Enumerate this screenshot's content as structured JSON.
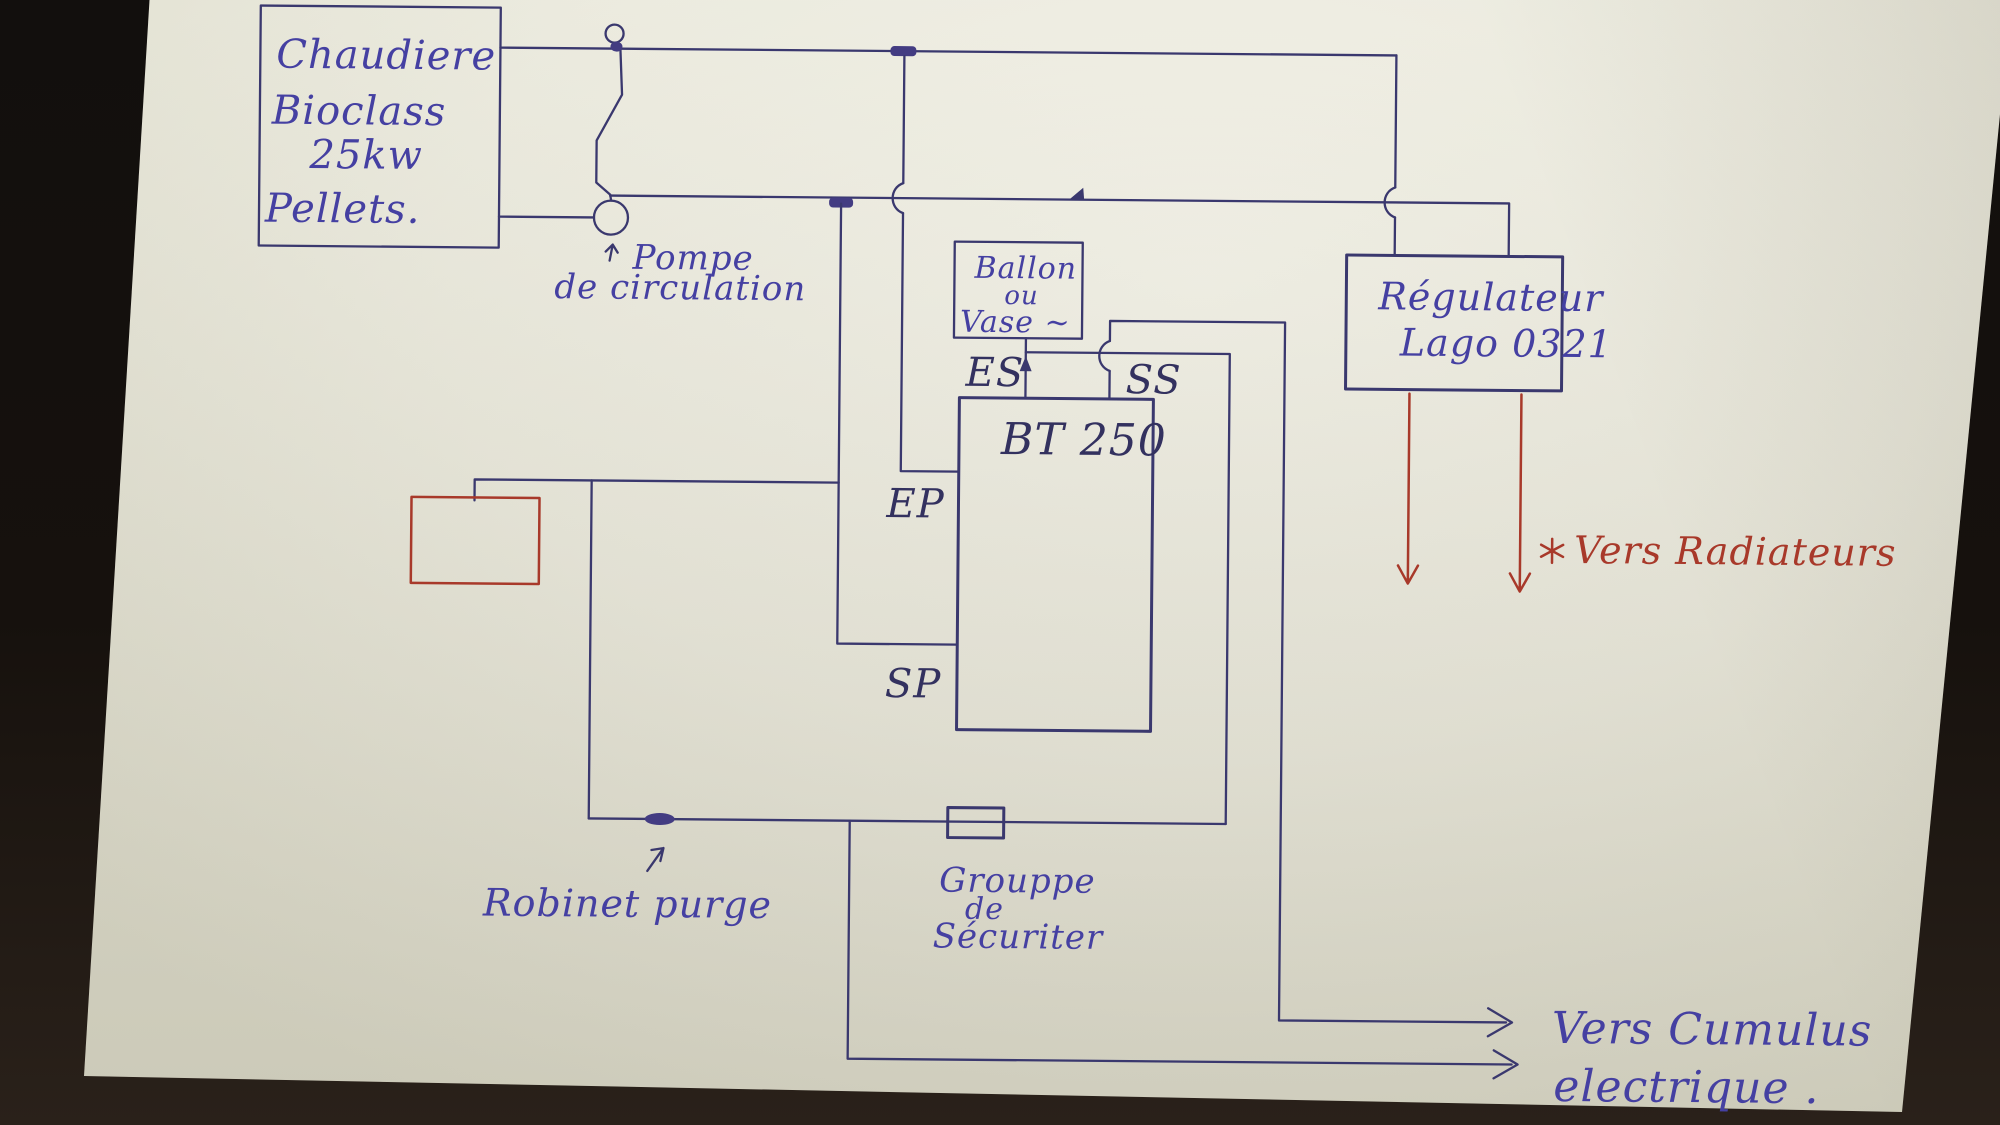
{
  "boiler": {
    "lines": [
      "Chaudiere",
      "Bioclass",
      "25kw",
      "Pellets."
    ]
  },
  "pump": {
    "line1": "Pompe",
    "line2": "de circulation"
  },
  "expansion_tank": {
    "line1": "Ballon",
    "line2": "ou",
    "line3": "Vase ~"
  },
  "buffer_tank": {
    "label": "BT 250",
    "port_es": "ES",
    "port_ss": "SS",
    "port_ep": "EP",
    "port_sp": "SP"
  },
  "regulator": {
    "line1": "Régulateur",
    "line2": "Lago 0321"
  },
  "radiators_note": {
    "label": "Vers Radiateurs"
  },
  "purge": {
    "label": "Robinet purge"
  },
  "safety_group": {
    "line1": "Grouppe",
    "line2": "de",
    "line3": "Sécuriter"
  },
  "cumulus_note": {
    "line1": "Vers Cumulus",
    "line2": "electrique ."
  },
  "colors": {
    "ink_blue_handwriting": "#4540a2",
    "ink_blue_lines": "#3a386e",
    "ink_red": "#a8392a",
    "paper": "#eae9dc",
    "background": "#16110d"
  }
}
